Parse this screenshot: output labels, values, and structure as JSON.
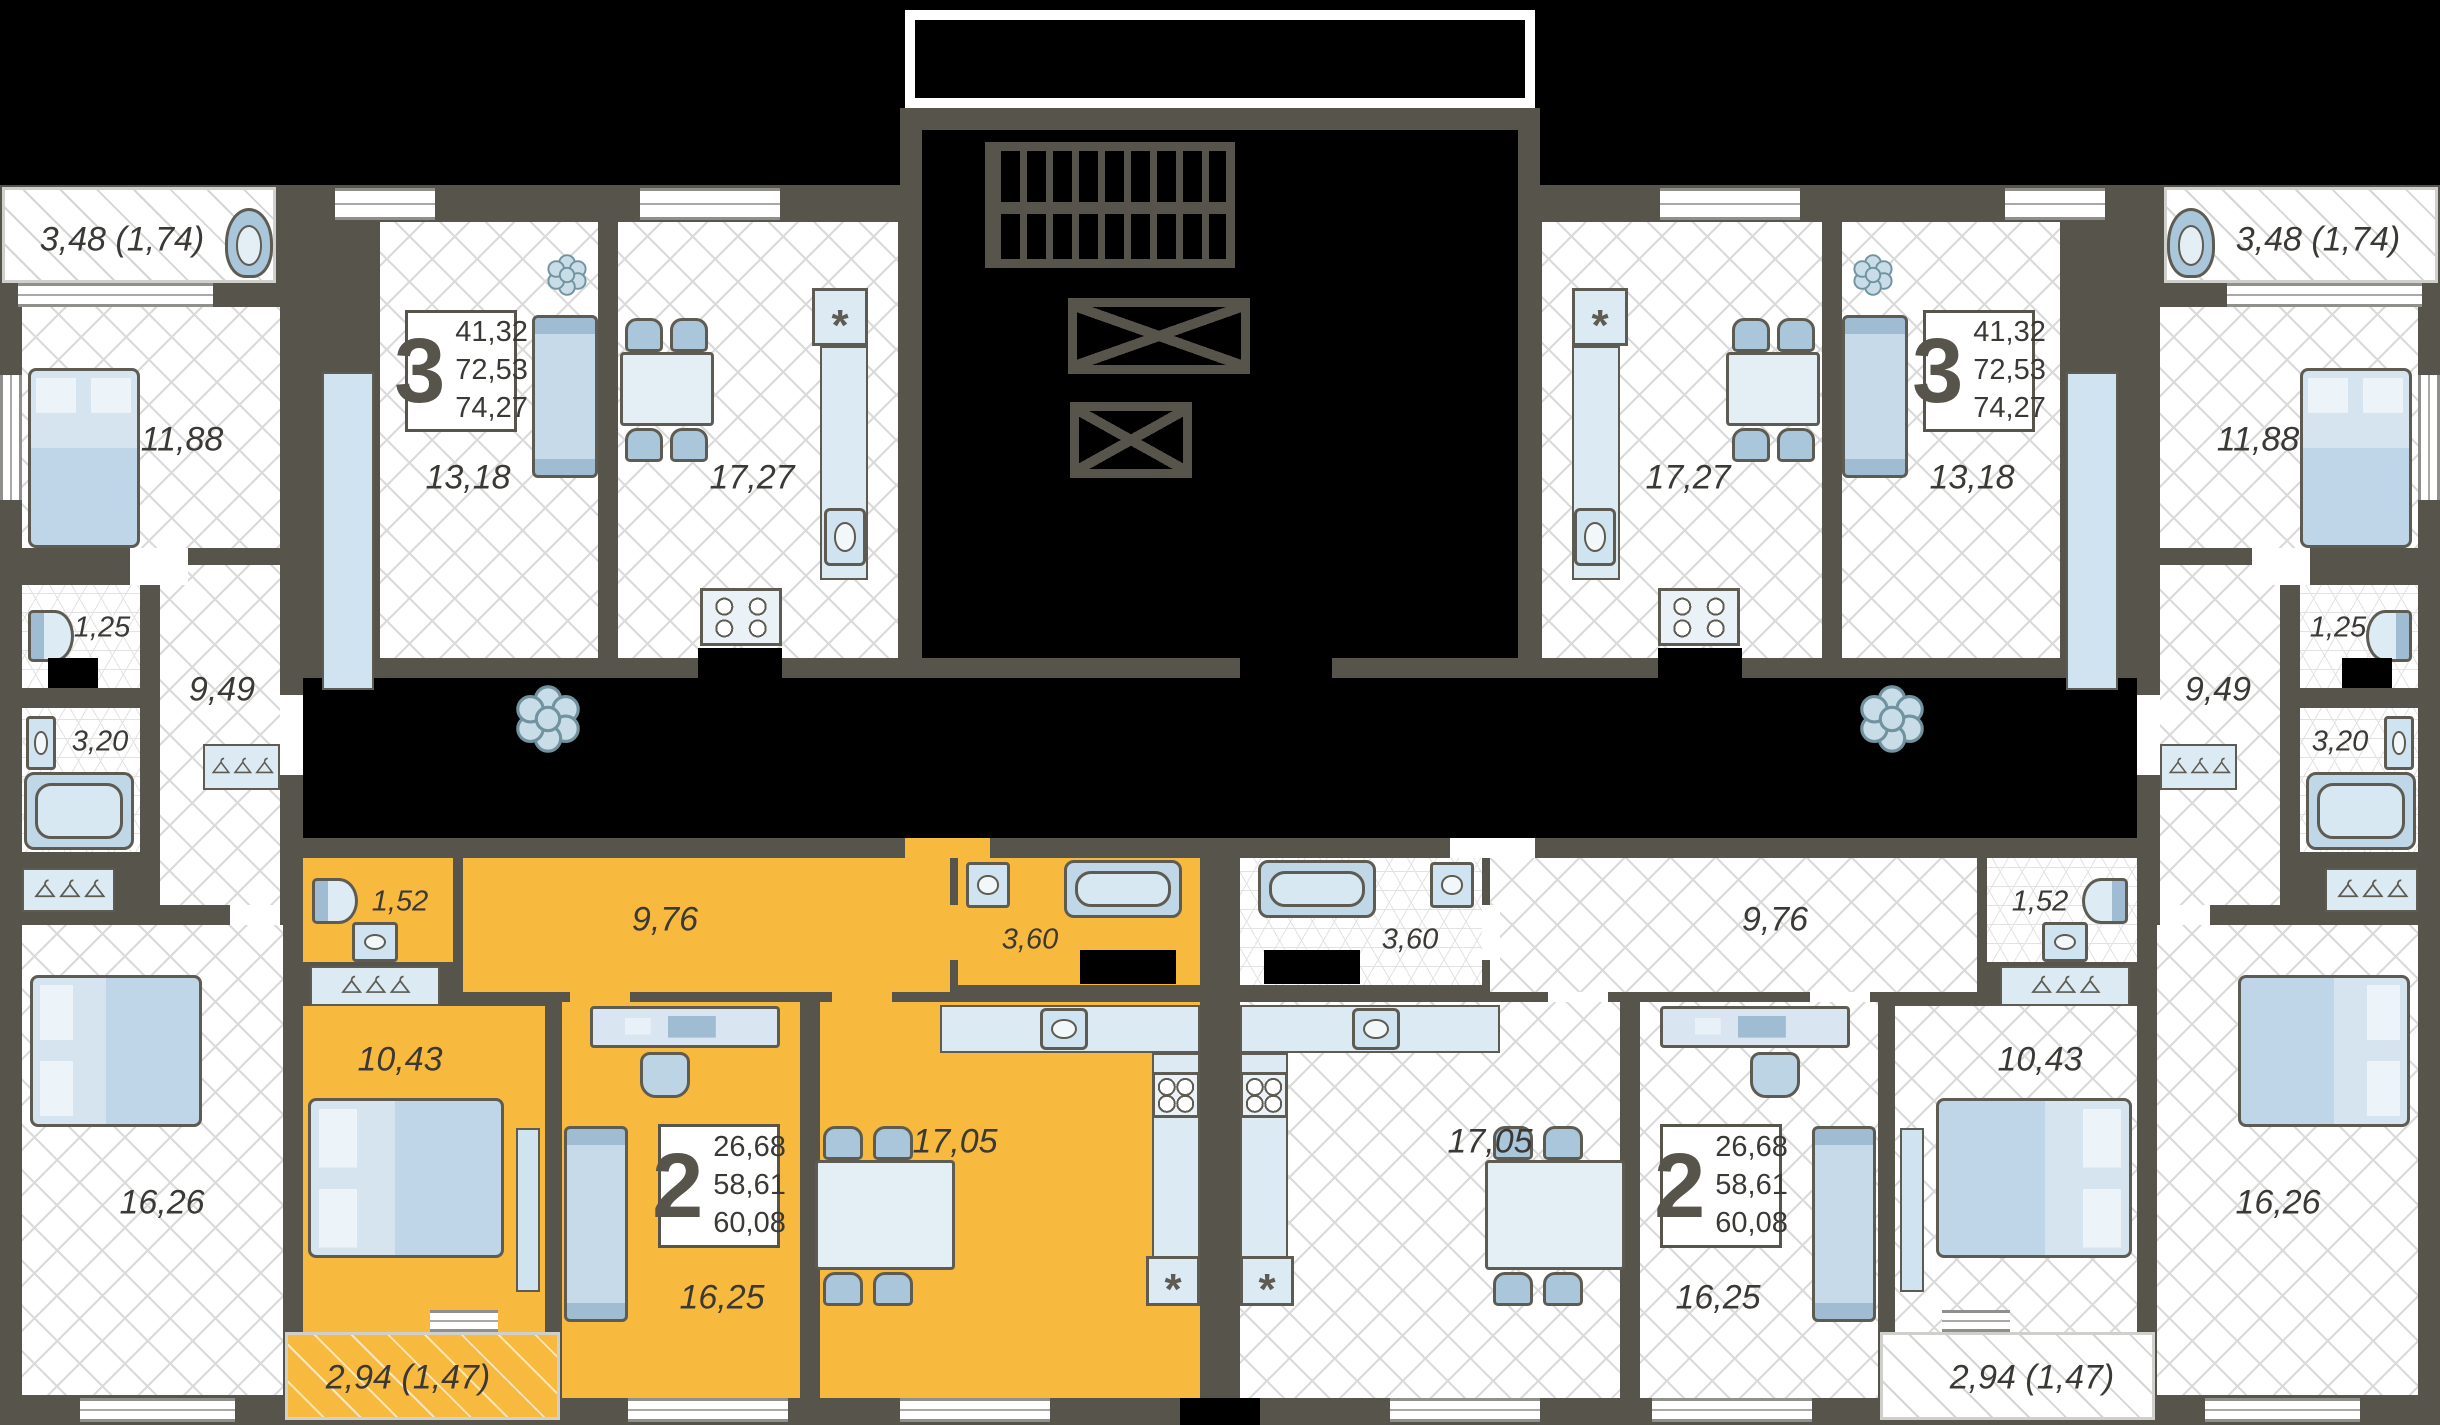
{
  "colors": {
    "background": "#000000",
    "walls": "#57544C",
    "highlight_apartment": "#F8B93F",
    "furniture": "#D9E6F1",
    "floor": "#FFFFFF",
    "hatch_line": "#DADADA"
  },
  "apartments": [
    {
      "id": "3-room-left",
      "digit": "3",
      "stats": [
        "41,32",
        "72,53",
        "74,27"
      ],
      "rooms": {
        "balcony": "3,48 (1,74)",
        "bedroom": "11,88",
        "living": "13,18",
        "kitchen": "17,27",
        "wc": "1,25",
        "bath": "3,20",
        "hall": "9,49",
        "bedroom2": "16,26"
      }
    },
    {
      "id": "2-room-left-highlighted",
      "digit": "2",
      "stats": [
        "26,68",
        "58,61",
        "60,08"
      ],
      "rooms": {
        "wc": "1,52",
        "hall": "9,76",
        "bath": "3,60",
        "bedroom": "10,43",
        "living": "16,25",
        "kitchen": "17,05",
        "balcony": "2,94 (1,47)"
      }
    },
    {
      "id": "3-room-right",
      "digit": "3",
      "stats": [
        "41,32",
        "72,53",
        "74,27"
      ],
      "rooms": {
        "balcony": "3,48 (1,74)",
        "bedroom": "11,88",
        "living": "13,18",
        "kitchen": "17,27",
        "wc": "1,25",
        "bath": "3,20",
        "hall": "9,49",
        "bedroom2": "16,26"
      }
    },
    {
      "id": "2-room-right",
      "digit": "2",
      "stats": [
        "26,68",
        "58,61",
        "60,08"
      ],
      "rooms": {
        "wc": "1,52",
        "hall": "9,76",
        "bath": "3,60",
        "bedroom": "10,43",
        "living": "16,25",
        "kitchen": "17,05",
        "balcony": "2,94 (1,47)"
      }
    }
  ]
}
